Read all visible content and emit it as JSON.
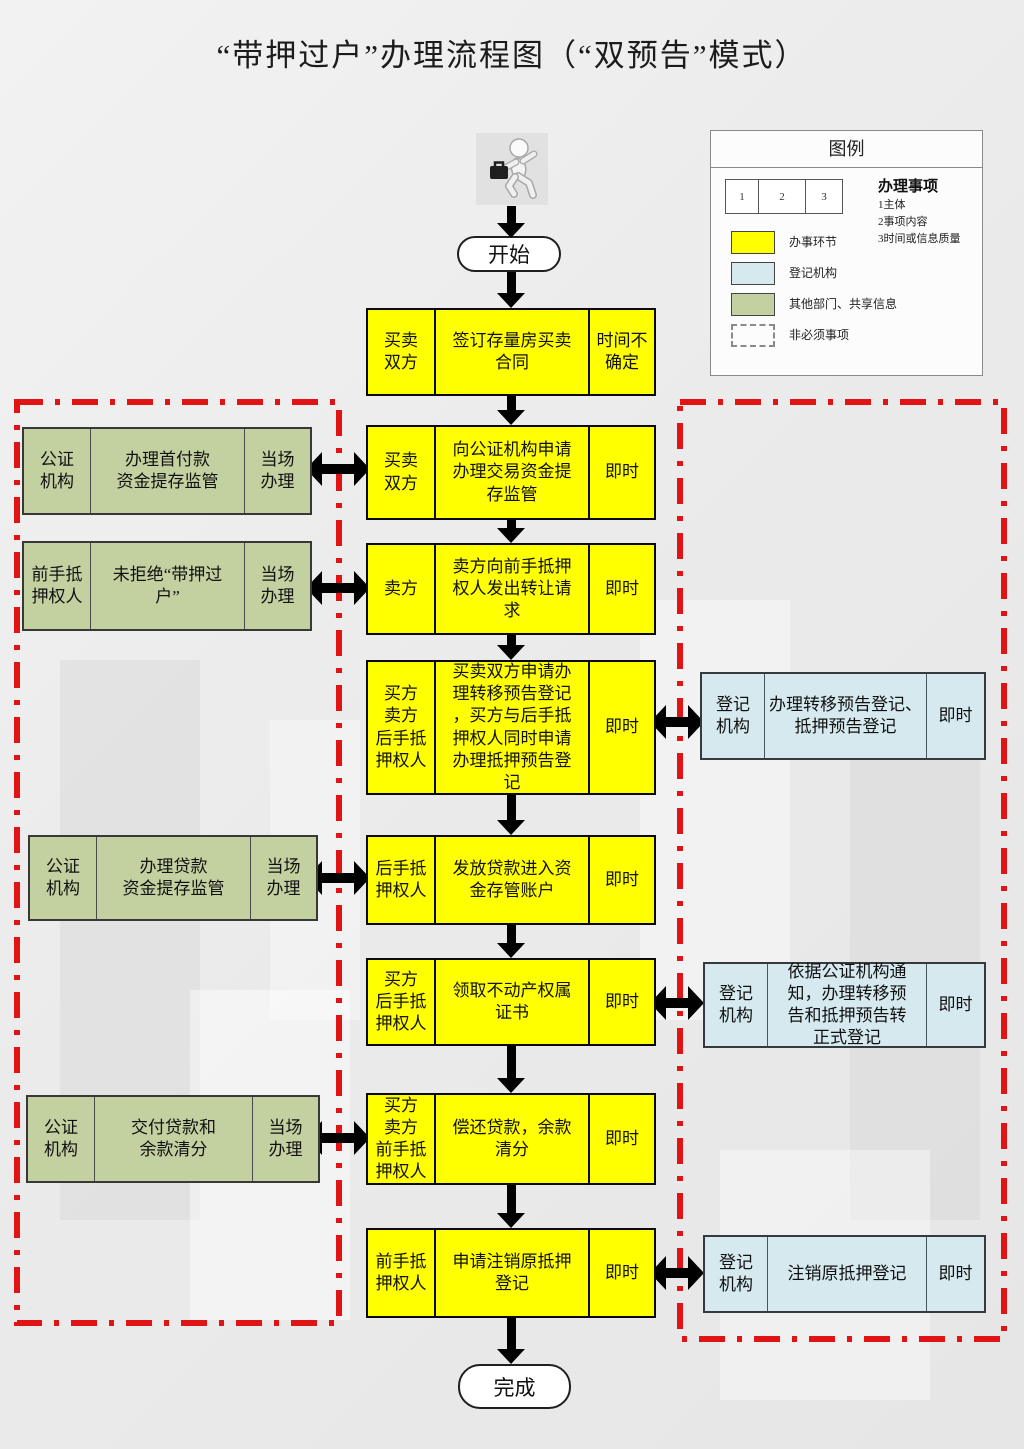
{
  "title": "“带押过户”办理流程图（“双预告”模式）",
  "start_label": "开始",
  "end_label": "完成",
  "colors": {
    "process_yellow": "#ffff00",
    "registry_blue": "#d5e9ef",
    "other_green": "#c3d0a0",
    "boundary_red": "#e01414"
  },
  "legend": {
    "title": "图例",
    "sample_cells": [
      "1",
      "2",
      "3"
    ],
    "items_heading": "办理事项",
    "items_lines": [
      "1主体",
      "2事项内容",
      "3时间或信息质量"
    ],
    "swatches": [
      {
        "label": "办事环节",
        "color": "#ffff00"
      },
      {
        "label": "登记机构",
        "color": "#d5e9ef"
      },
      {
        "label": "其他部门、共享信息",
        "color": "#c3d0a0"
      },
      {
        "label": "非必须事项",
        "color": "dashed-outline"
      }
    ]
  },
  "flow": {
    "rows": [
      {
        "subject": "买卖\n双方",
        "content": "签订存量房买卖\n合同",
        "time": "时间不\n确定"
      },
      {
        "subject": "买卖\n双方",
        "content": "向公证机构申请\n办理交易资金提\n存监管",
        "time": "即时"
      },
      {
        "subject": "卖方",
        "content": "卖方向前手抵押\n权人发出转让请\n求",
        "time": "即时"
      },
      {
        "subject": "买方\n卖方\n后手抵\n押权人",
        "content": "买卖双方申请办\n理转移预告登记\n，买方与后手抵\n押权人同时申请\n办理抵押预告登\n记",
        "time": "即时"
      },
      {
        "subject": "后手抵\n押权人",
        "content": "发放贷款进入资\n金存管账户",
        "time": "即时"
      },
      {
        "subject": "买方\n后手抵\n押权人",
        "content": "领取不动产权属\n证书",
        "time": "即时"
      },
      {
        "subject": "买方\n卖方\n前手抵\n押权人",
        "content": "偿还贷款，余款\n清分",
        "time": "即时"
      },
      {
        "subject": "前手抵\n押权人",
        "content": "申请注销原抵押\n登记",
        "time": "即时"
      }
    ],
    "left_boxes": [
      {
        "subject": "公证\n机构",
        "content": "办理首付款\n资金提存监管",
        "time": "当场\n办理"
      },
      {
        "subject": "前手抵\n押权人",
        "content": "未拒绝“带押过\n户”",
        "time": "当场\n办理"
      },
      {
        "subject": "公证\n机构",
        "content": "办理贷款\n资金提存监管",
        "time": "当场\n办理"
      },
      {
        "subject": "公证\n机构",
        "content": "交付贷款和\n余款清分",
        "time": "当场\n办理"
      }
    ],
    "right_boxes": [
      {
        "subject": "登记\n机构",
        "content": "办理转移预告登记、\n抵押预告登记",
        "time": "即时"
      },
      {
        "subject": "登记\n机构",
        "content": "依据公证机构通\n知，办理转移预\n告和抵押预告转\n正式登记",
        "time": "即时"
      },
      {
        "subject": "登记\n机构",
        "content": "注销原抵押登记",
        "time": "即时"
      }
    ]
  }
}
